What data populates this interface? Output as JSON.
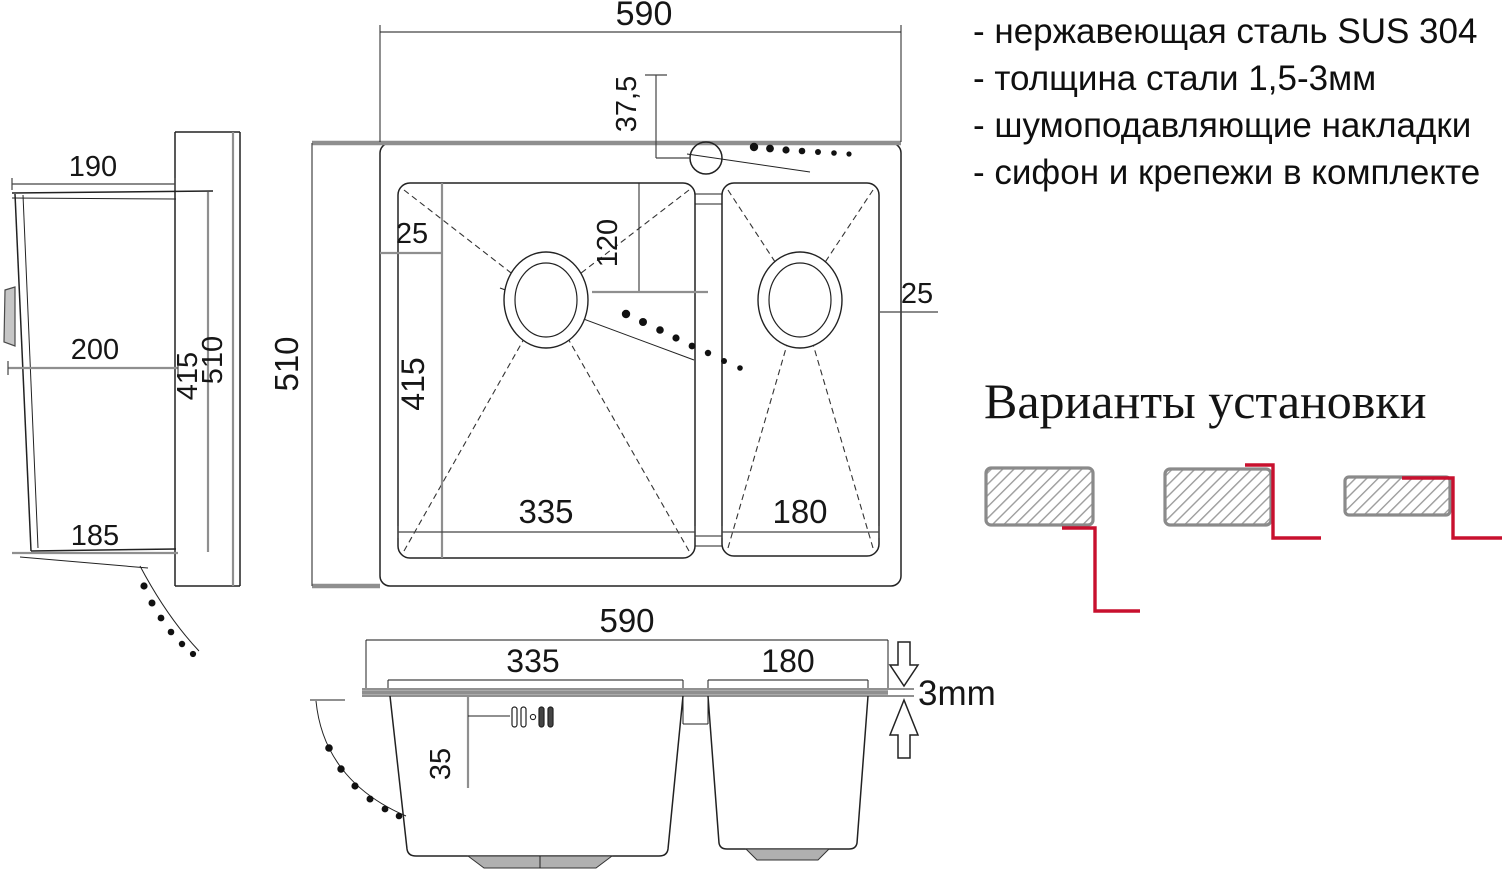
{
  "specs": {
    "items": [
      "- нержавеющая сталь SUS 304",
      "- толщина стали 1,5-3мм",
      "- шумоподавляющие накладки",
      "- сифон и крепежи в комплекте"
    ]
  },
  "installation": {
    "title": "Варианты установки"
  },
  "top_view": {
    "overall_width": "590",
    "overall_depth": "510",
    "faucet_offset": "37,5",
    "left_gap": "25",
    "right_gap": "25",
    "drain_offset": "120",
    "bowl_length": "415",
    "main_bowl_width": "335",
    "half_bowl_width": "180"
  },
  "front_view": {
    "overall_width": "590",
    "main_bowl_width": "335",
    "half_bowl_width": "180",
    "overflow_offset": "35",
    "panel_thickness": "3mm"
  },
  "side_view": {
    "top_width": "190",
    "bowl_depth": "200",
    "bottom_width": "185",
    "inner_length": "415",
    "overall_length": "510"
  },
  "colors": {
    "accent_red": "#c8102e",
    "dim_gray": "#8f8f8f",
    "hatch_gray": "#9c9c9c",
    "line_black": "#1a1a1a"
  },
  "icons": {
    "faucet_hole": "faucet-hole-icon",
    "drain": "drain-icon",
    "overflow": "overflow-slots-icon",
    "hose": "drain-hose-dots-icon",
    "clip": "mounting-clip-icon",
    "thickness_arrows": "thickness-arrow-icon",
    "variant_profiles": "countertop-profile-icon"
  }
}
